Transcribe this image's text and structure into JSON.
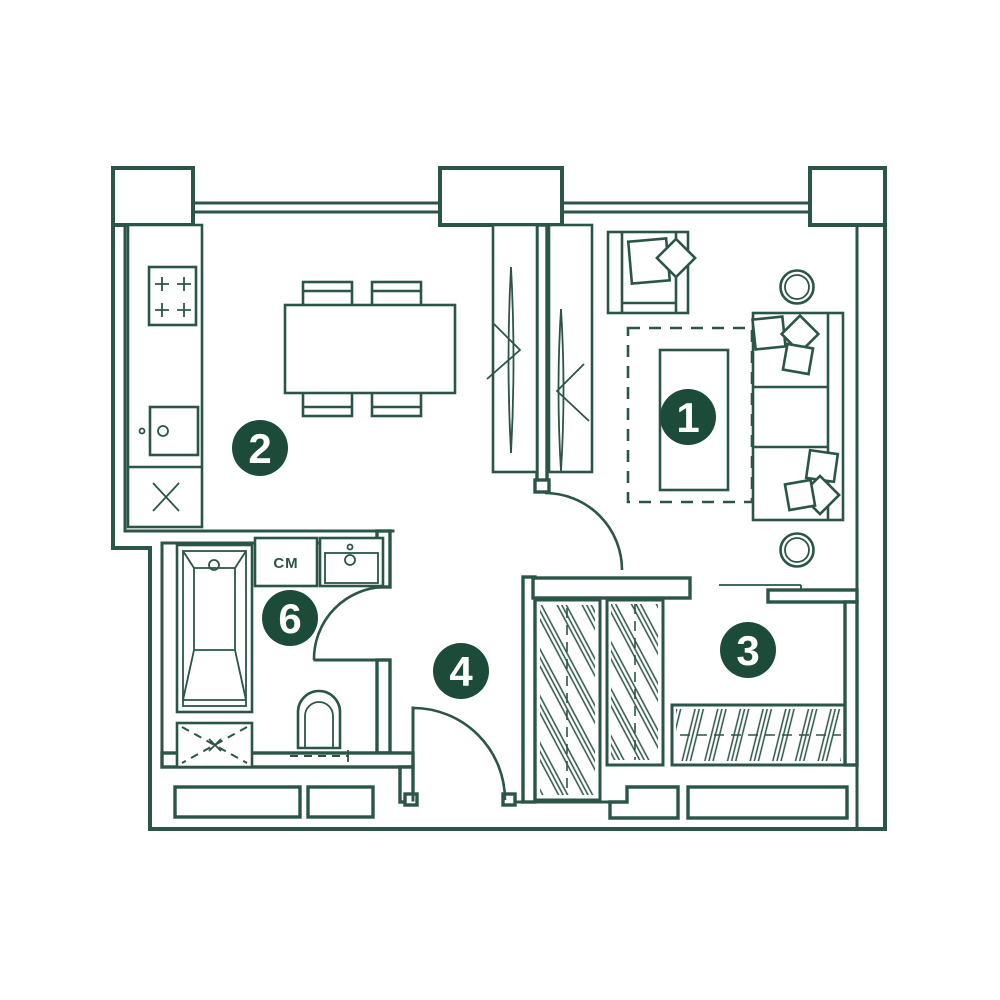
{
  "colors": {
    "line": "#2b5548",
    "badge_fill": "#1d4b39",
    "badge_text": "#ffffff",
    "background": "#ffffff"
  },
  "rooms": [
    {
      "number": "1",
      "name": "living-room"
    },
    {
      "number": "2",
      "name": "kitchen-dining"
    },
    {
      "number": "3",
      "name": "wardrobe-hall"
    },
    {
      "number": "4",
      "name": "corridor"
    },
    {
      "number": "6",
      "name": "bathroom"
    }
  ],
  "appliance_labels": {
    "washing_machine": "CM"
  }
}
